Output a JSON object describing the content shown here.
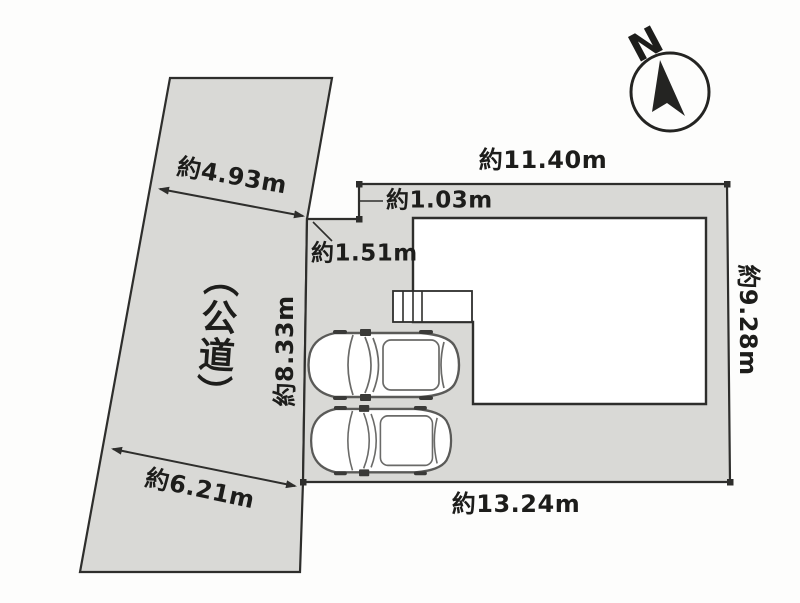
{
  "colors": {
    "background": "#fdfdfc",
    "land_fill": "#d9d9d6",
    "line": "#2e2e2c",
    "text": "#1d1d1b"
  },
  "compass": {
    "north_label": "N"
  },
  "road": {
    "label": "（公道）"
  },
  "dimensions": {
    "road_width_upper": "約4.93m",
    "road_width_lower": "約6.21m",
    "plot_top": "約11.40m",
    "plot_right": "約9.28m",
    "plot_left": "約8.33m",
    "plot_bottom": "約13.24m",
    "notch_depth": "約1.03m",
    "frontage_segment": "約1.51m"
  }
}
